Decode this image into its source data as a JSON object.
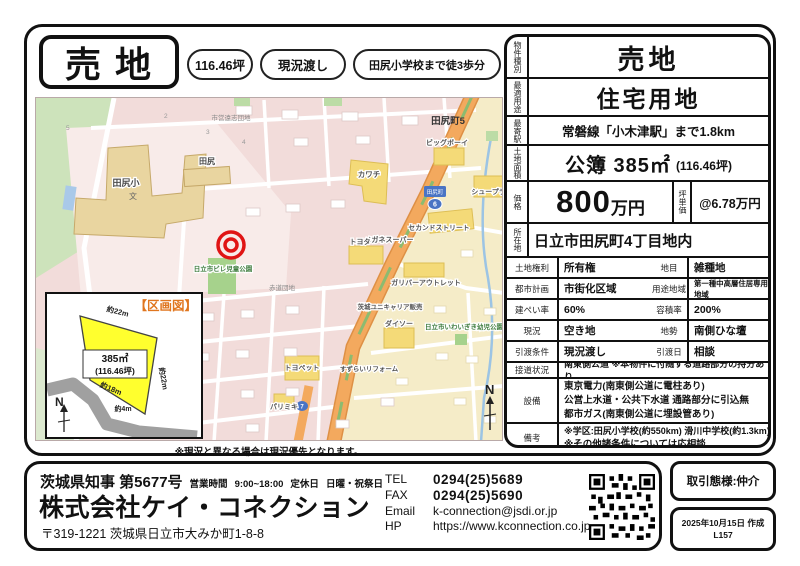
{
  "header": {
    "title": "売 地",
    "badges": {
      "b1": "116.46坪",
      "b2": "現況渡し",
      "b3": "田尻小学校まで徒3歩分"
    }
  },
  "table": {
    "r1_label": "物件種別",
    "r1_value": "売地",
    "r2_label": "最適用途",
    "r2_value": "住宅用地",
    "r3_label": "最寄駅",
    "r3_value": "常磐線「小木津駅」まで1.8km",
    "r4_label": "土地面積",
    "r4_main": "公簿 385㎡",
    "r4_sub": "(116.46坪)",
    "r5_label": "価格",
    "r5_num": "800",
    "r5_unit": "万円",
    "r5_label2": "坪単価",
    "r5_value2": "@6.78万円",
    "r6_label": "所在地",
    "r6_value": "日立市田尻町4丁目地内",
    "r7a_label": "土地権利",
    "r7a": "所有権",
    "r7b_label": "地目",
    "r7b": "雑種地",
    "r8a_label": "都市計画",
    "r8a": "市街化区域",
    "r8b_label": "用途地域",
    "r8b": "第一種中高層住居専用地域",
    "r9a_label": "建ぺい率",
    "r9a": "60%",
    "r9b_label": "容積率",
    "r9b": "200%",
    "r10a_label": "現況",
    "r10a": "空き地",
    "r10b_label": "地勢",
    "r10b": "南側ひな壇",
    "r11a_label": "引渡条件",
    "r11a": "現況渡し",
    "r11b_label": "引渡日",
    "r11b": "相談",
    "r12_label": "接道状況",
    "r12": "南東側公道 ※本物件に付随する道路部分の持分あり",
    "r13_label": "設備",
    "r13_1": "東京電力(南東側公道に電柱あり)",
    "r13_2": "公営上水道・公共下水道 通路部分に引込無",
    "r13_3": "都市ガス(南東側公道に埋設管あり)",
    "r14_label": "備考",
    "r14_1": "※学区:田尻小学校(約550km) 滑川中学校(約1.3km)",
    "r14_2": "※その他諸条件については応相談"
  },
  "map": {
    "labels": {
      "school": "田尻小",
      "school_mark": "文",
      "tajiri": "田尻",
      "shiei": "市営遠志団地",
      "sekido": "赤道団地",
      "hotoke": "仏ヶ浜史跡",
      "big_boy": "ビッグボーイ",
      "kawachi": "カワチ",
      "shoe": "シュープラザ",
      "second": "セカンドストリート",
      "megane": "メガネスーパー",
      "toyota": "トヨタ",
      "gulliver": "ガリバーアウトレット",
      "tajiri5": "田尻町5",
      "park1": "日立市ビレ児童公園",
      "park2": "日立市いわいぎき幼児公園",
      "unicarrier": "茨城ユニキャリア販売",
      "daiso": "ダイソー",
      "suzuran": "すずらいリフォーム",
      "toyopet": "トヨペット",
      "parimiki": "パリミキ",
      "sign_town": "田尻町",
      "route6": "6",
      "route7": "7",
      "north": "N",
      "n1": "2",
      "n2": "3",
      "n3": "4",
      "n4": "5"
    },
    "note": "※現況と異なる場合は現況優先となります。",
    "inset": {
      "title": "【区画図】",
      "area": "385㎡",
      "tsubo": "(116.46坪)",
      "d_top": "約22m",
      "d_right": "約22m",
      "d_left": "約18m",
      "d_bottom": "約4m",
      "north": "N"
    }
  },
  "footer": {
    "license": "茨城県知事 第5677号",
    "hours_label": "営業時間",
    "hours": "9:00~18:00",
    "closed_label": "定休日",
    "closed": "日曜・祝祭日",
    "company": "株式会社ケイ・コネクション",
    "address": "〒319-1221 茨城県日立市大みか町1-8-8",
    "tel_label": "TEL",
    "tel": "0294(25)5689",
    "fax_label": "FAX",
    "fax": "0294(25)5690",
    "email_label": "Email",
    "email": "k-connection@jsdi.or.jp",
    "hp_label": "HP",
    "hp": "https://www.kconnection.co.jp",
    "transaction": "取引態様:仲介",
    "created": "2025年10月15日 作成",
    "doc_no": "L157"
  },
  "colors": {
    "accent_orange": "#e0761f",
    "lot_yellow": "#ffff2e",
    "marker_red": "#e01414",
    "highway_orange": "#f3a95e"
  }
}
